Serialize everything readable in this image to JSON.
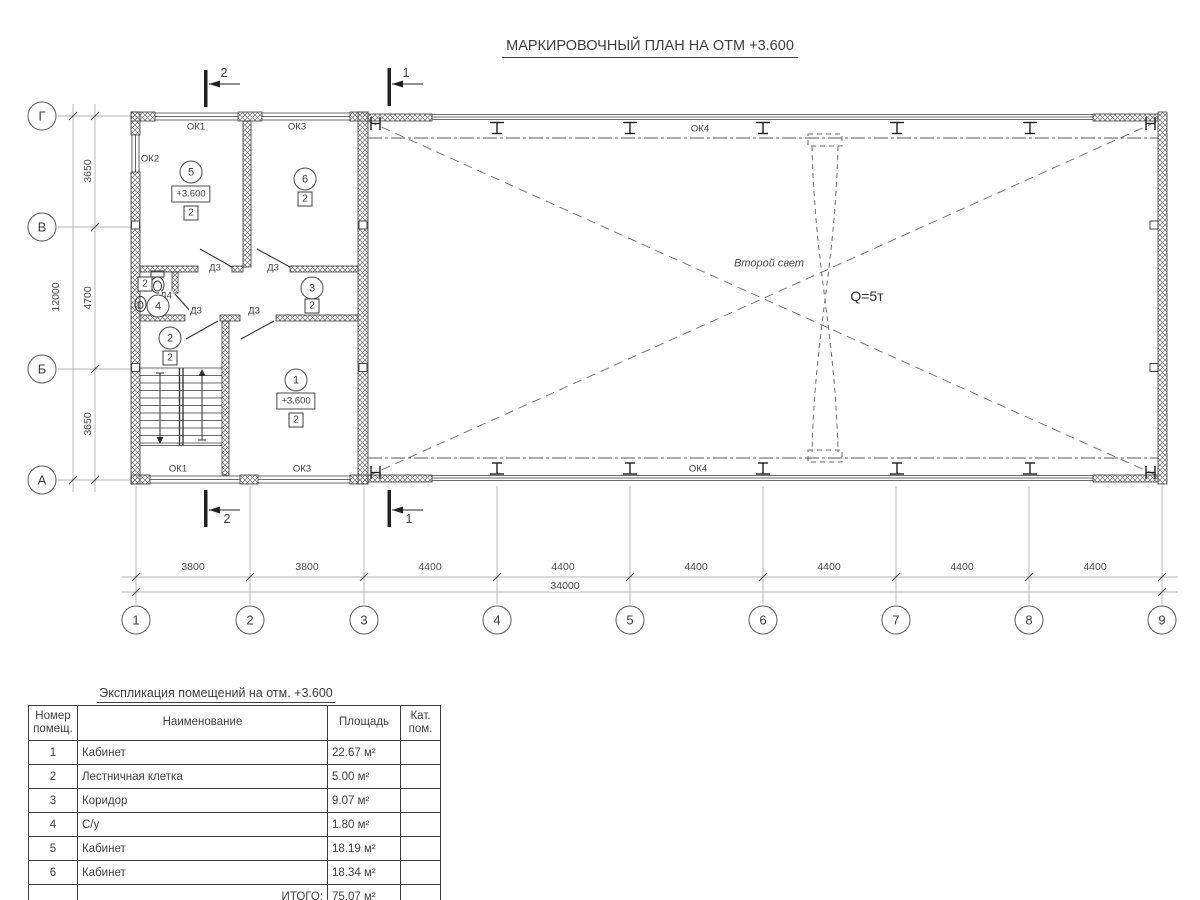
{
  "title": "МАРКИРОВОЧНЫЙ ПЛАН НА ОТМ +3.600",
  "plan": {
    "sections": {
      "s1": "1",
      "s2": "2"
    },
    "windows": {
      "ok1": "ОК1",
      "ok2": "ОК2",
      "ok3": "ОК3",
      "ok4": "ОК4"
    },
    "doors": {
      "d3": "Д3",
      "d4": "Д4"
    },
    "rooms": {
      "r1": {
        "num": "1",
        "elev": "+3.600",
        "cat": "2"
      },
      "r2": {
        "num": "2",
        "cat": "2"
      },
      "r3": {
        "num": "3",
        "cat": "2"
      },
      "r4": {
        "num": "4",
        "cat": "2"
      },
      "r5": {
        "num": "5",
        "elev": "+3.600",
        "cat": "2"
      },
      "r6": {
        "num": "6",
        "cat": "2"
      }
    },
    "hall": {
      "second_light": "Второй свет",
      "crane_capacity": "Q=5т"
    },
    "grid": {
      "cols": [
        "1",
        "2",
        "3",
        "4",
        "5",
        "6",
        "7",
        "8",
        "9"
      ],
      "rows": [
        "Г",
        "В",
        "Б",
        "А"
      ],
      "col_dims": [
        "3800",
        "3800",
        "4400",
        "4400",
        "4400",
        "4400",
        "4400",
        "4400"
      ],
      "row_dims": [
        "3650",
        "4700",
        "3650"
      ],
      "total_width": "34000",
      "total_height": "12000"
    }
  },
  "table": {
    "title": "Экспликация помещений на отм. +3.600",
    "headers": {
      "num": "Номер помещ.",
      "name": "Наименование",
      "area": "Площадь",
      "cat": "Кат. пом."
    },
    "rows": [
      {
        "num": "1",
        "name": "Кабинет",
        "area": "22.67 м²"
      },
      {
        "num": "2",
        "name": "Лестничная клетка",
        "area": "5.00 м²"
      },
      {
        "num": "3",
        "name": "Коридор",
        "area": "9.07 м²"
      },
      {
        "num": "4",
        "name": "С/у",
        "area": "1.80 м²"
      },
      {
        "num": "5",
        "name": "Кабинет",
        "area": "18.19 м²"
      },
      {
        "num": "6",
        "name": "Кабинет",
        "area": "18.34 м²"
      }
    ],
    "total_label": "ИТОГО:",
    "total_area": "75.07 м²"
  }
}
